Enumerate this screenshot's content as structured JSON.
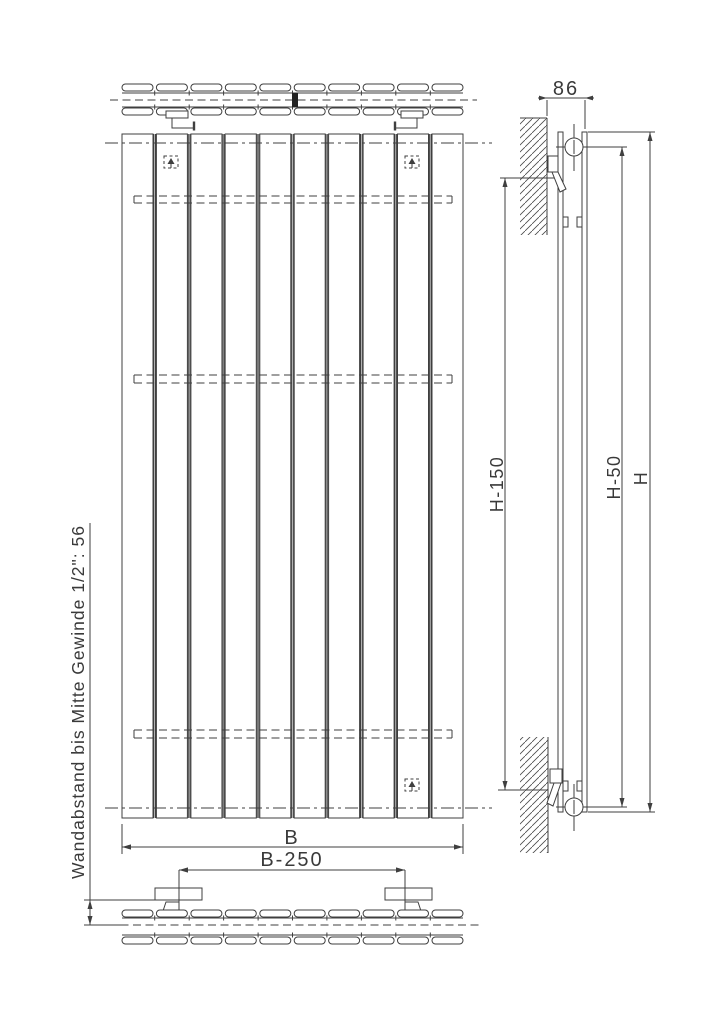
{
  "drawing": {
    "background": "#ffffff",
    "line_color": "#3f3f3f",
    "labels": {
      "depth_top_right": "86",
      "height_full": "H",
      "height_minus_50": "H-50",
      "height_minus_150": "H-150",
      "width": "B",
      "bracket_spacing": "B-250",
      "wall_distance_note": "Wandabstand bis Mitte Gewinde 1/2\": 56"
    },
    "front_view": {
      "panel_count": 10,
      "hidden_collector_count": 3,
      "mount_marker_count": 3
    },
    "top_view": {
      "tubes_per_row": 10,
      "rows": 2
    },
    "bottom_view": {
      "tubes_per_row": 10,
      "rows": 2,
      "wall_bracket_count": 2
    }
  }
}
